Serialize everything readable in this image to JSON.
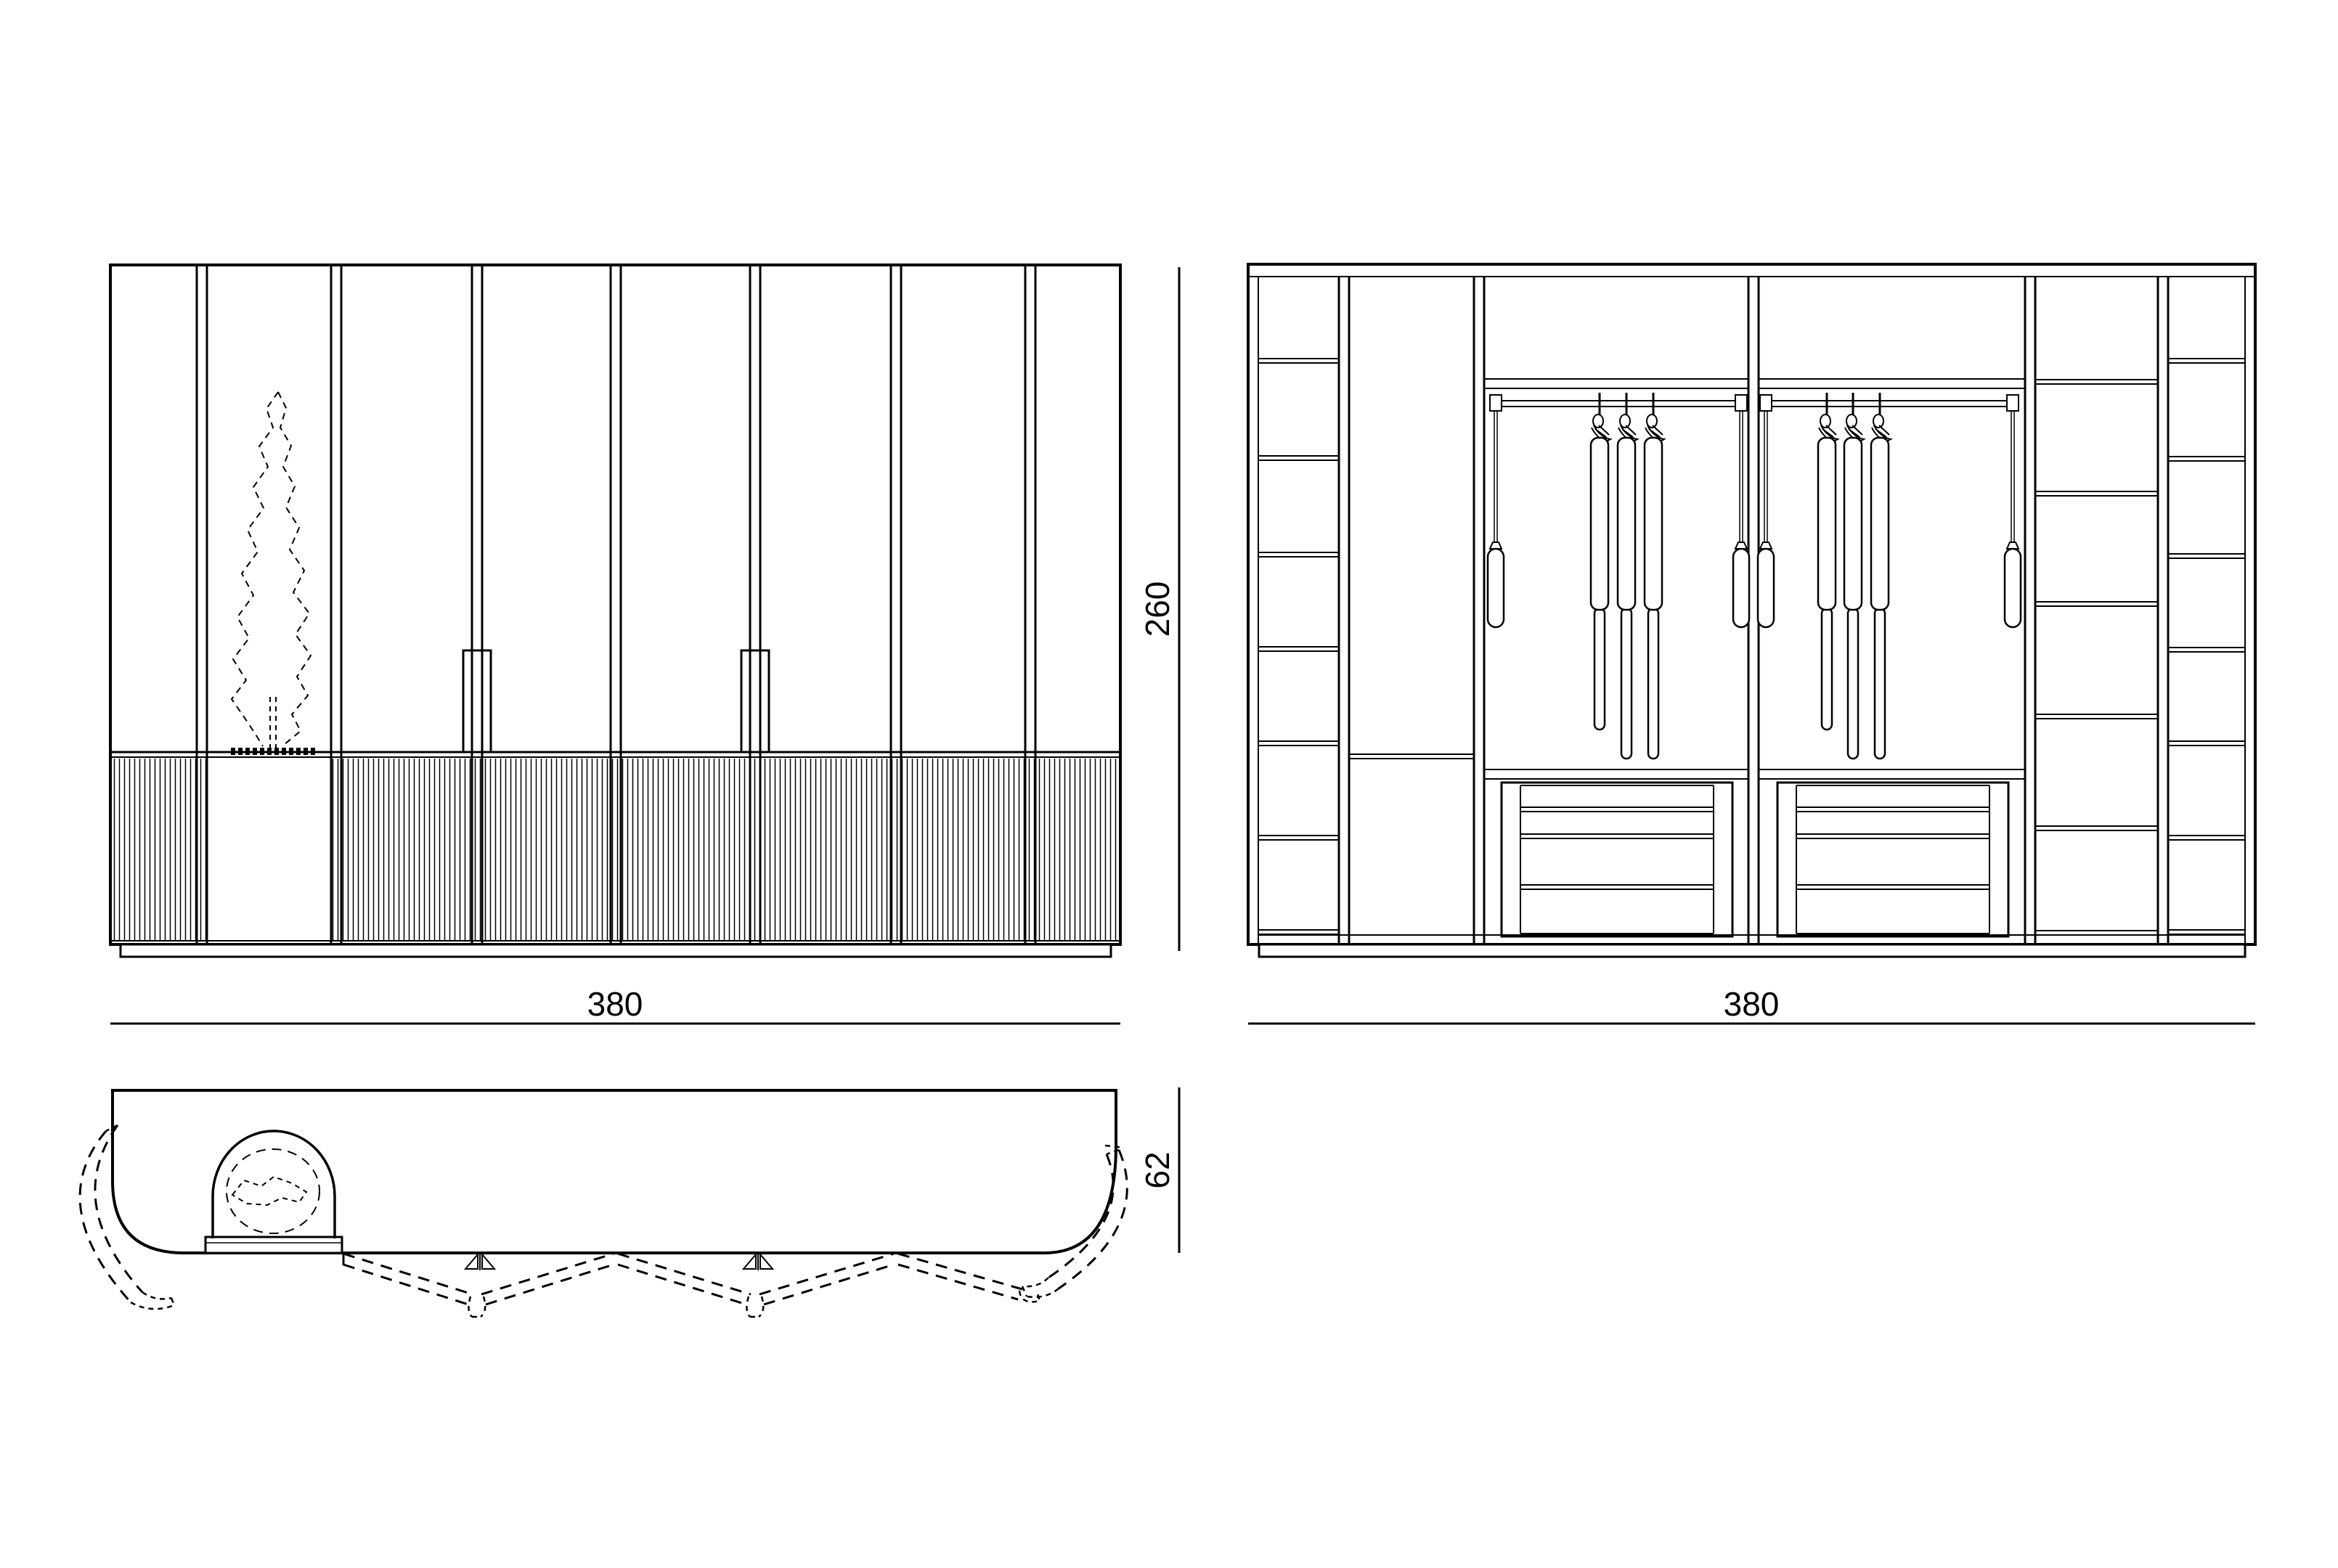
{
  "drawing": {
    "background": "#ffffff",
    "ink": "#000000",
    "views": {
      "front_elevation": {
        "width_label": "380"
      },
      "interior_elevation": {
        "width_label": "380"
      },
      "shared_height_label": "260",
      "plan": {
        "depth_label": "62"
      }
    }
  }
}
